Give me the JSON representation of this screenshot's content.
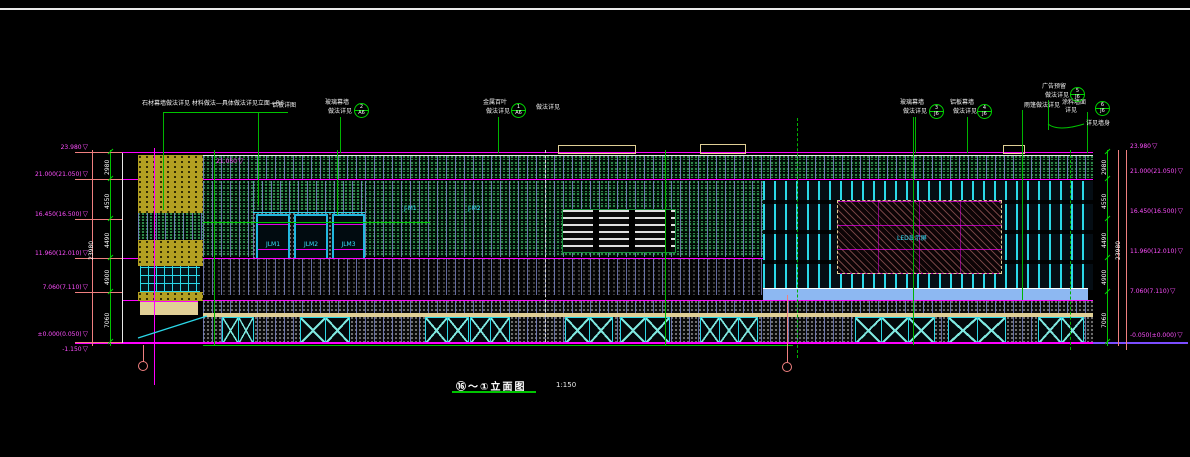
{
  "title_block": {
    "title": "⑯～①立面图",
    "scale": "1:150"
  },
  "annotations": {
    "items": [
      {
        "label": "石材幕墙做法详见 材料做法—具体做法详见立面—R6"
      },
      {
        "label": "铝板详图"
      },
      {
        "label": "玻璃幕墙",
        "label2": "做法详见"
      },
      {
        "label": "金属百叶",
        "label2": "做法详见",
        "side": "做法详见"
      },
      {
        "label": "玻璃幕墙",
        "label2": "做法详见"
      },
      {
        "label": "铝板幕墙",
        "label2": "做法详见"
      },
      {
        "label": "雨篷做法详见"
      },
      {
        "label": "广告预留",
        "label2": "做法详见"
      },
      {
        "label": "涂料墙面",
        "label2": "详见"
      },
      {
        "label": "详见墙身"
      }
    ],
    "bubbles": [
      {
        "top": "2",
        "bottom": "A6"
      },
      {
        "top": "1",
        "bottom": "A6"
      },
      {
        "top": "3",
        "bottom": "J6"
      },
      {
        "top": "4",
        "bottom": "J6"
      },
      {
        "top": "5",
        "bottom": "J6"
      },
      {
        "top": "6",
        "bottom": "J6"
      }
    ]
  },
  "elevations": {
    "symbol": "▽",
    "inner": "21.050",
    "left": [
      "23.980",
      "21.000(21.050)",
      "16.450(16.500)",
      "11.960(12.010)",
      "7.060(7.110)",
      "±0.000(0.050)",
      "-1.150"
    ],
    "right": [
      "23.980",
      "21.000(21.050)",
      "16.450(16.500)",
      "11.960(12.010)",
      "7.060(7.110)",
      "-0.050(±0.000)"
    ]
  },
  "dimensions": {
    "left": [
      "2980",
      "4550",
      "4490",
      "4900",
      "7060"
    ],
    "right": [
      "2980",
      "4550",
      "4490",
      "4900",
      "7060"
    ],
    "left_total": "23980",
    "right_total": "23980"
  },
  "facade_labels": {
    "window1": "JLM1",
    "window2": "JLM2",
    "window3": "JLM3",
    "glass1": "J-M1",
    "glass2": "J-M2",
    "led": "LED显示屏"
  },
  "colors": {
    "background": "#000000",
    "grid_magenta": "#FF00FF",
    "leader_green": "#00D400",
    "frame_cyan": "#2BD8E8",
    "dim_salmon": "#F08080",
    "panel_khaki": "#E0CF96",
    "block_yellow": "#B8A820",
    "mullion_slate": "#7B86C8",
    "canopy_blue": "#8DB8F2",
    "baseline_purple": "#7C4DFF",
    "hatch_green": "#1C7A3C"
  }
}
